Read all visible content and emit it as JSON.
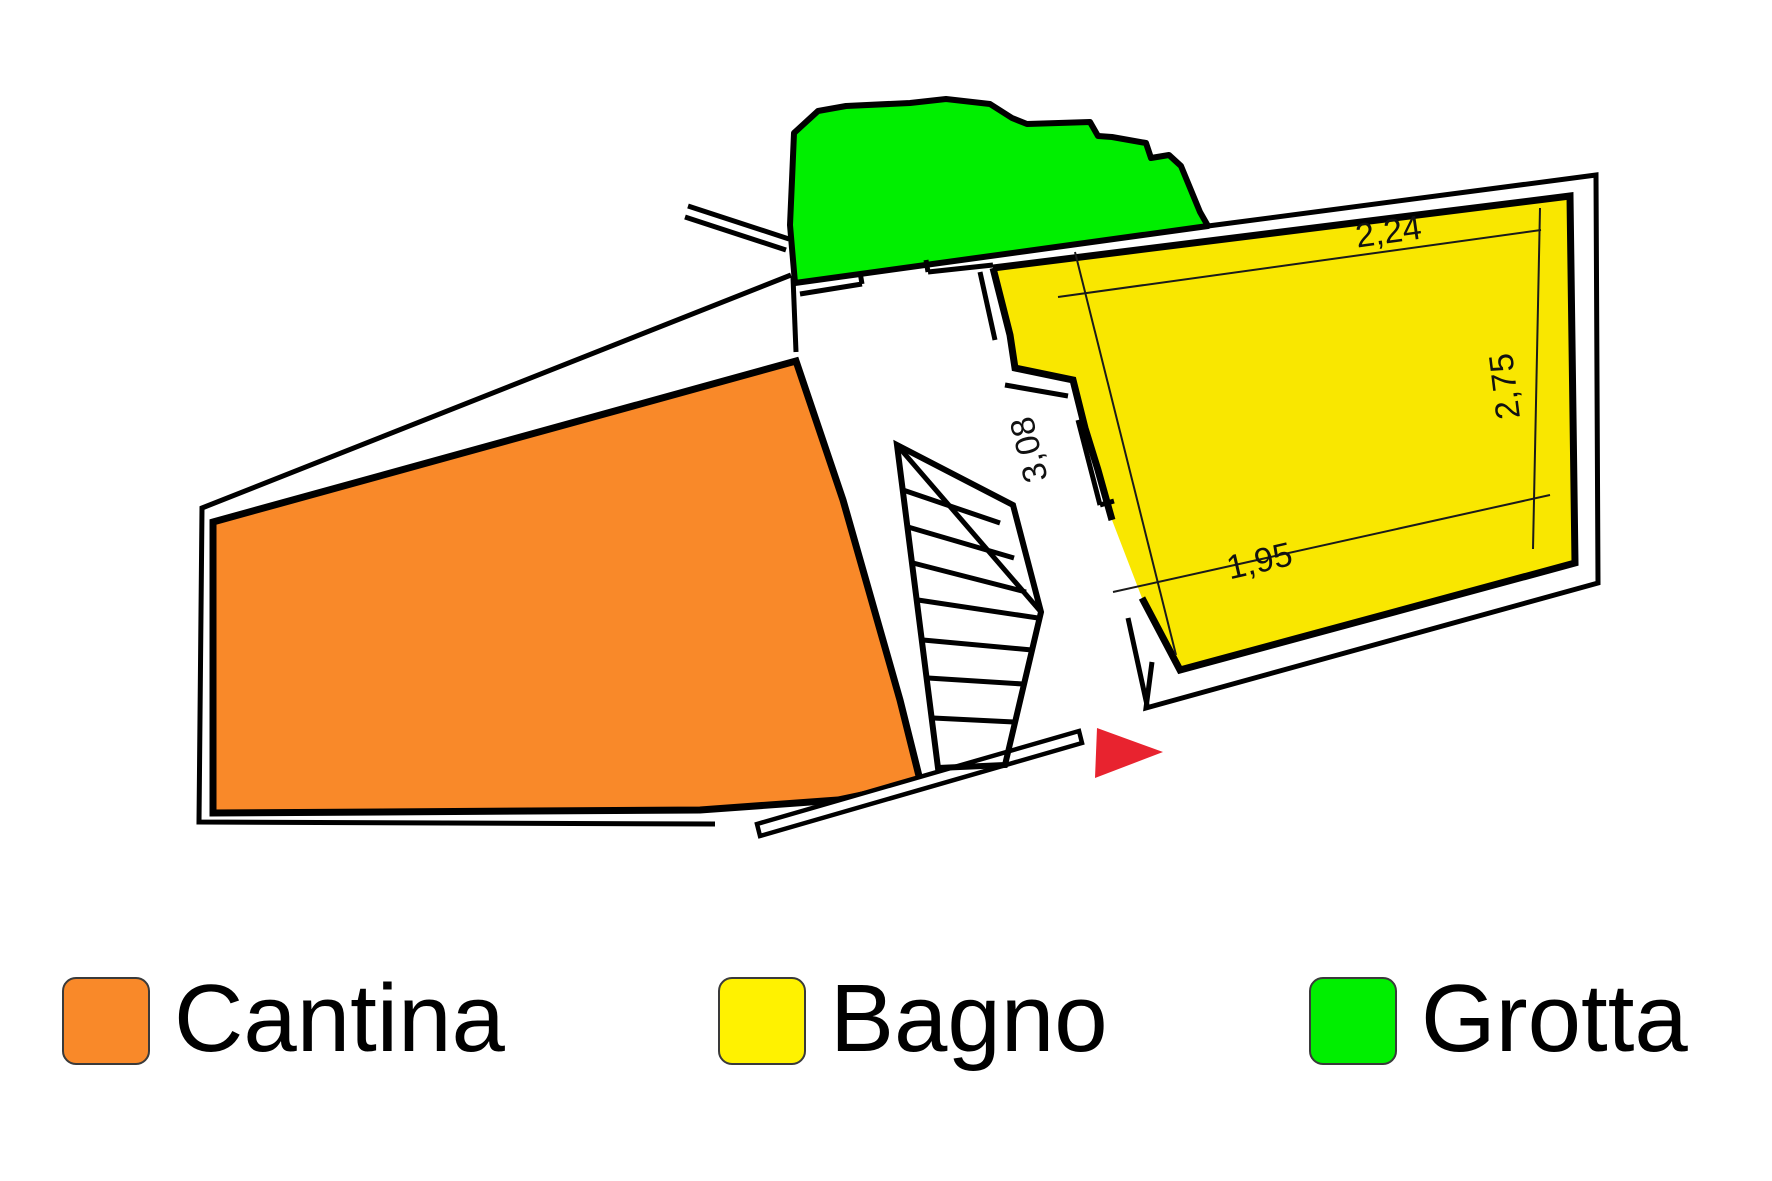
{
  "plan": {
    "dimensions": [
      {
        "id": "top",
        "value": "2,24"
      },
      {
        "id": "right",
        "value": "2,75"
      },
      {
        "id": "left",
        "value": "3,08"
      },
      {
        "id": "bottom",
        "value": "1,95"
      }
    ],
    "colors": {
      "cantina": "#F98929",
      "bagno": "#F9E700",
      "grotta": "#00EF00",
      "arrow": "#E8232F",
      "wall": "#000000"
    }
  },
  "legend": {
    "items": [
      {
        "label": "Cantina",
        "color": "#F98929"
      },
      {
        "label": "Bagno",
        "color": "#FFF200"
      },
      {
        "label": "Grotta",
        "color": "#00EF00"
      }
    ]
  }
}
